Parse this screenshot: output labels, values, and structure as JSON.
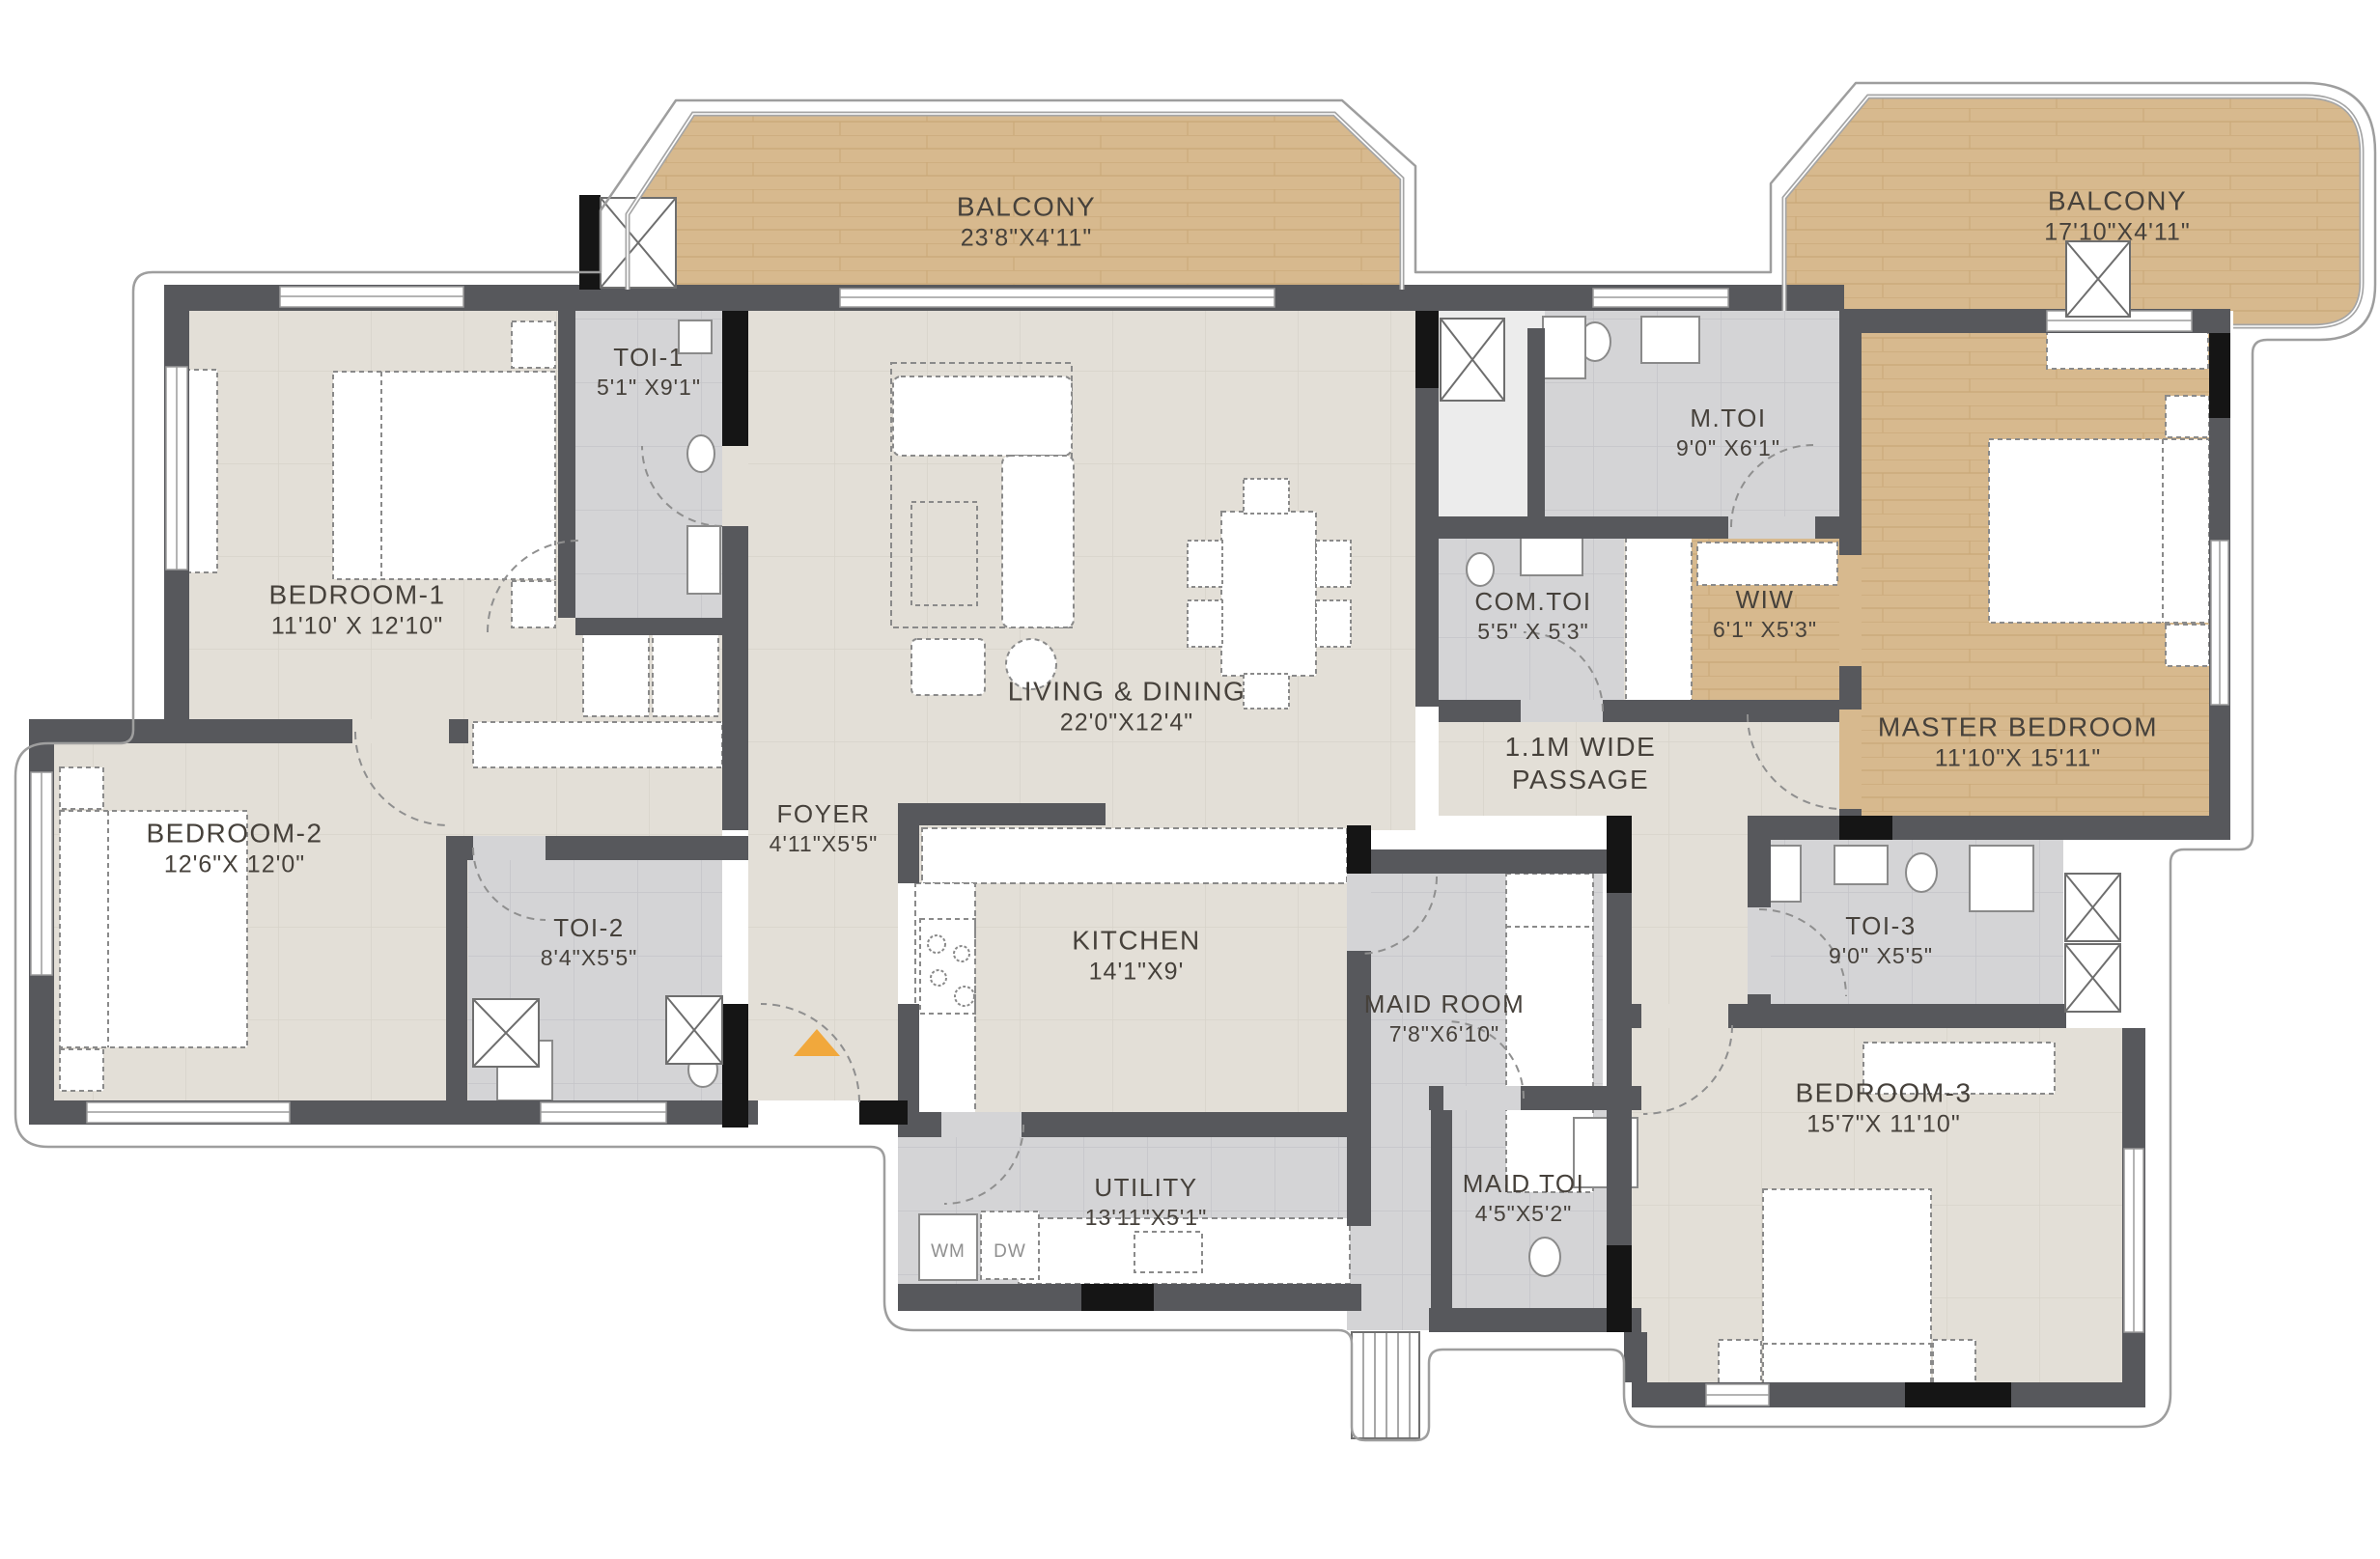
{
  "rooms": [
    {
      "id": "balcony-1",
      "name": "BALCONY",
      "dims": "23'8\"X4'11\""
    },
    {
      "id": "balcony-2",
      "name": "BALCONY",
      "dims": "17'10\"X4'11\""
    },
    {
      "id": "toi-1",
      "name": "TOI-1",
      "dims": "5'1\" X9'1\""
    },
    {
      "id": "bedroom-1",
      "name": "BEDROOM-1",
      "dims": "11'10' X 12'10\""
    },
    {
      "id": "m-toi",
      "name": "M.TOI",
      "dims": "9'0\" X6'1\""
    },
    {
      "id": "com-toi",
      "name": "COM.TOI",
      "dims": "5'5\" X 5'3\""
    },
    {
      "id": "wiw",
      "name": "WIW",
      "dims": "6'1\" X5'3\""
    },
    {
      "id": "living-dining",
      "name": "LIVING & DINING",
      "dims": "22'0\"X12'4\""
    },
    {
      "id": "master-bedroom",
      "name": "MASTER BEDROOM",
      "dims": "11'10\"X 15'11\""
    },
    {
      "id": "passage",
      "name": "1.1M WIDE",
      "dims": "PASSAGE"
    },
    {
      "id": "bedroom-2",
      "name": "BEDROOM-2",
      "dims": "12'6\"X 12'0\""
    },
    {
      "id": "toi-2",
      "name": "TOI-2",
      "dims": "8'4\"X5'5\""
    },
    {
      "id": "foyer",
      "name": "FOYER",
      "dims": "4'11\"X5'5\""
    },
    {
      "id": "kitchen",
      "name": "KITCHEN",
      "dims": "14'1\"X9'"
    },
    {
      "id": "maid-room",
      "name": "MAID ROOM",
      "dims": "7'8\"X6'10\""
    },
    {
      "id": "toi-3",
      "name": "TOI-3",
      "dims": "9'0\" X5'5\""
    },
    {
      "id": "bedroom-3",
      "name": "BEDROOM-3",
      "dims": "15'7\"X 11'10\""
    },
    {
      "id": "utility",
      "name": "UTILITY",
      "dims": "13'11\"X5'1\""
    },
    {
      "id": "maid-toi",
      "name": "MAID TOI",
      "dims": "4'5\"X5'2\""
    }
  ],
  "appliances": {
    "wm": "WM",
    "dw": "DW"
  },
  "colors": {
    "wood": "#D7B98E",
    "floor": "#E3DFD7",
    "tile": "#D4D4D6",
    "wall": "#57585C",
    "wall_black": "#151515",
    "entry_arrow": "#F1A83C",
    "label_text": "#46413B",
    "outline": "#9E9E9E"
  },
  "entry_marker": {
    "type": "up-triangle"
  }
}
